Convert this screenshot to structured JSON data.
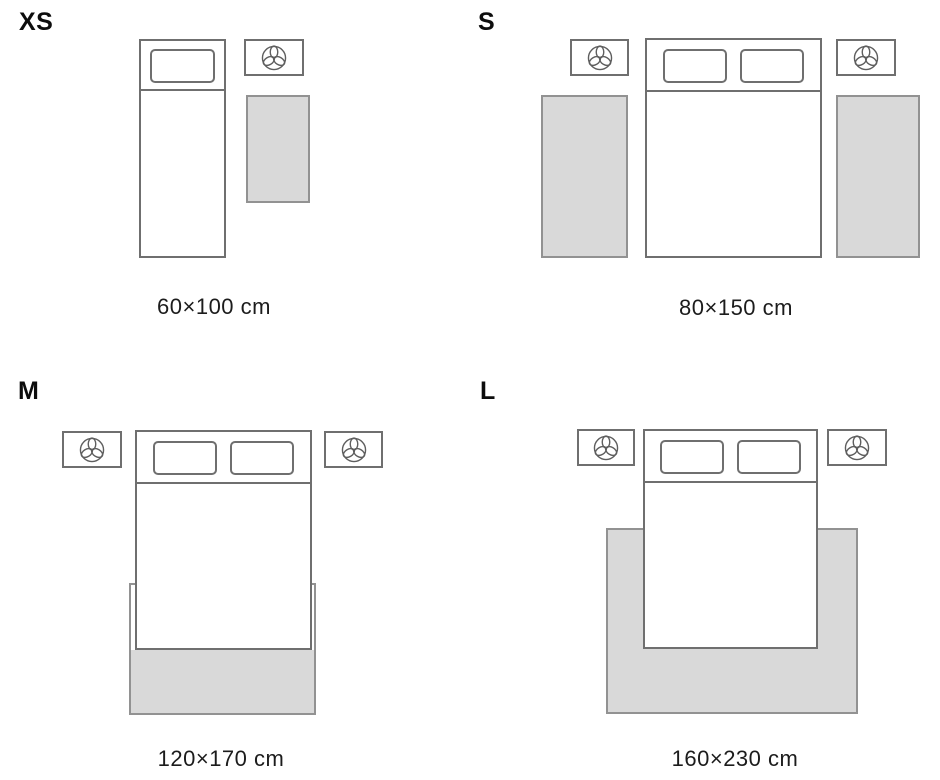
{
  "diagram": {
    "type": "rug-size-guide",
    "sizes": [
      {
        "label": "XS",
        "caption": "60×100 cm",
        "bed": "single",
        "rugs": 1,
        "rug_placement": "beside bed"
      },
      {
        "label": "S",
        "caption": "80×150 cm",
        "bed": "double",
        "rugs": 2,
        "rug_placement": "both sides of bed"
      },
      {
        "label": "M",
        "caption": "120×170 cm",
        "bed": "double",
        "rugs": 1,
        "rug_placement": "under foot of bed"
      },
      {
        "label": "L",
        "caption": "160×230 cm",
        "bed": "double",
        "rugs": 1,
        "rug_placement": "under bed, exposed on both sides and foot"
      }
    ]
  },
  "icons": {
    "nightstand_lamp": "lamp-top-view-icon"
  },
  "colors": {
    "background": "#ffffff",
    "outline": "#6f6f6f",
    "rug_border": "#929292",
    "rug_fill": "#d9d9d9",
    "label_text": "#0d0d0d",
    "caption_text": "#1c1c1c"
  }
}
